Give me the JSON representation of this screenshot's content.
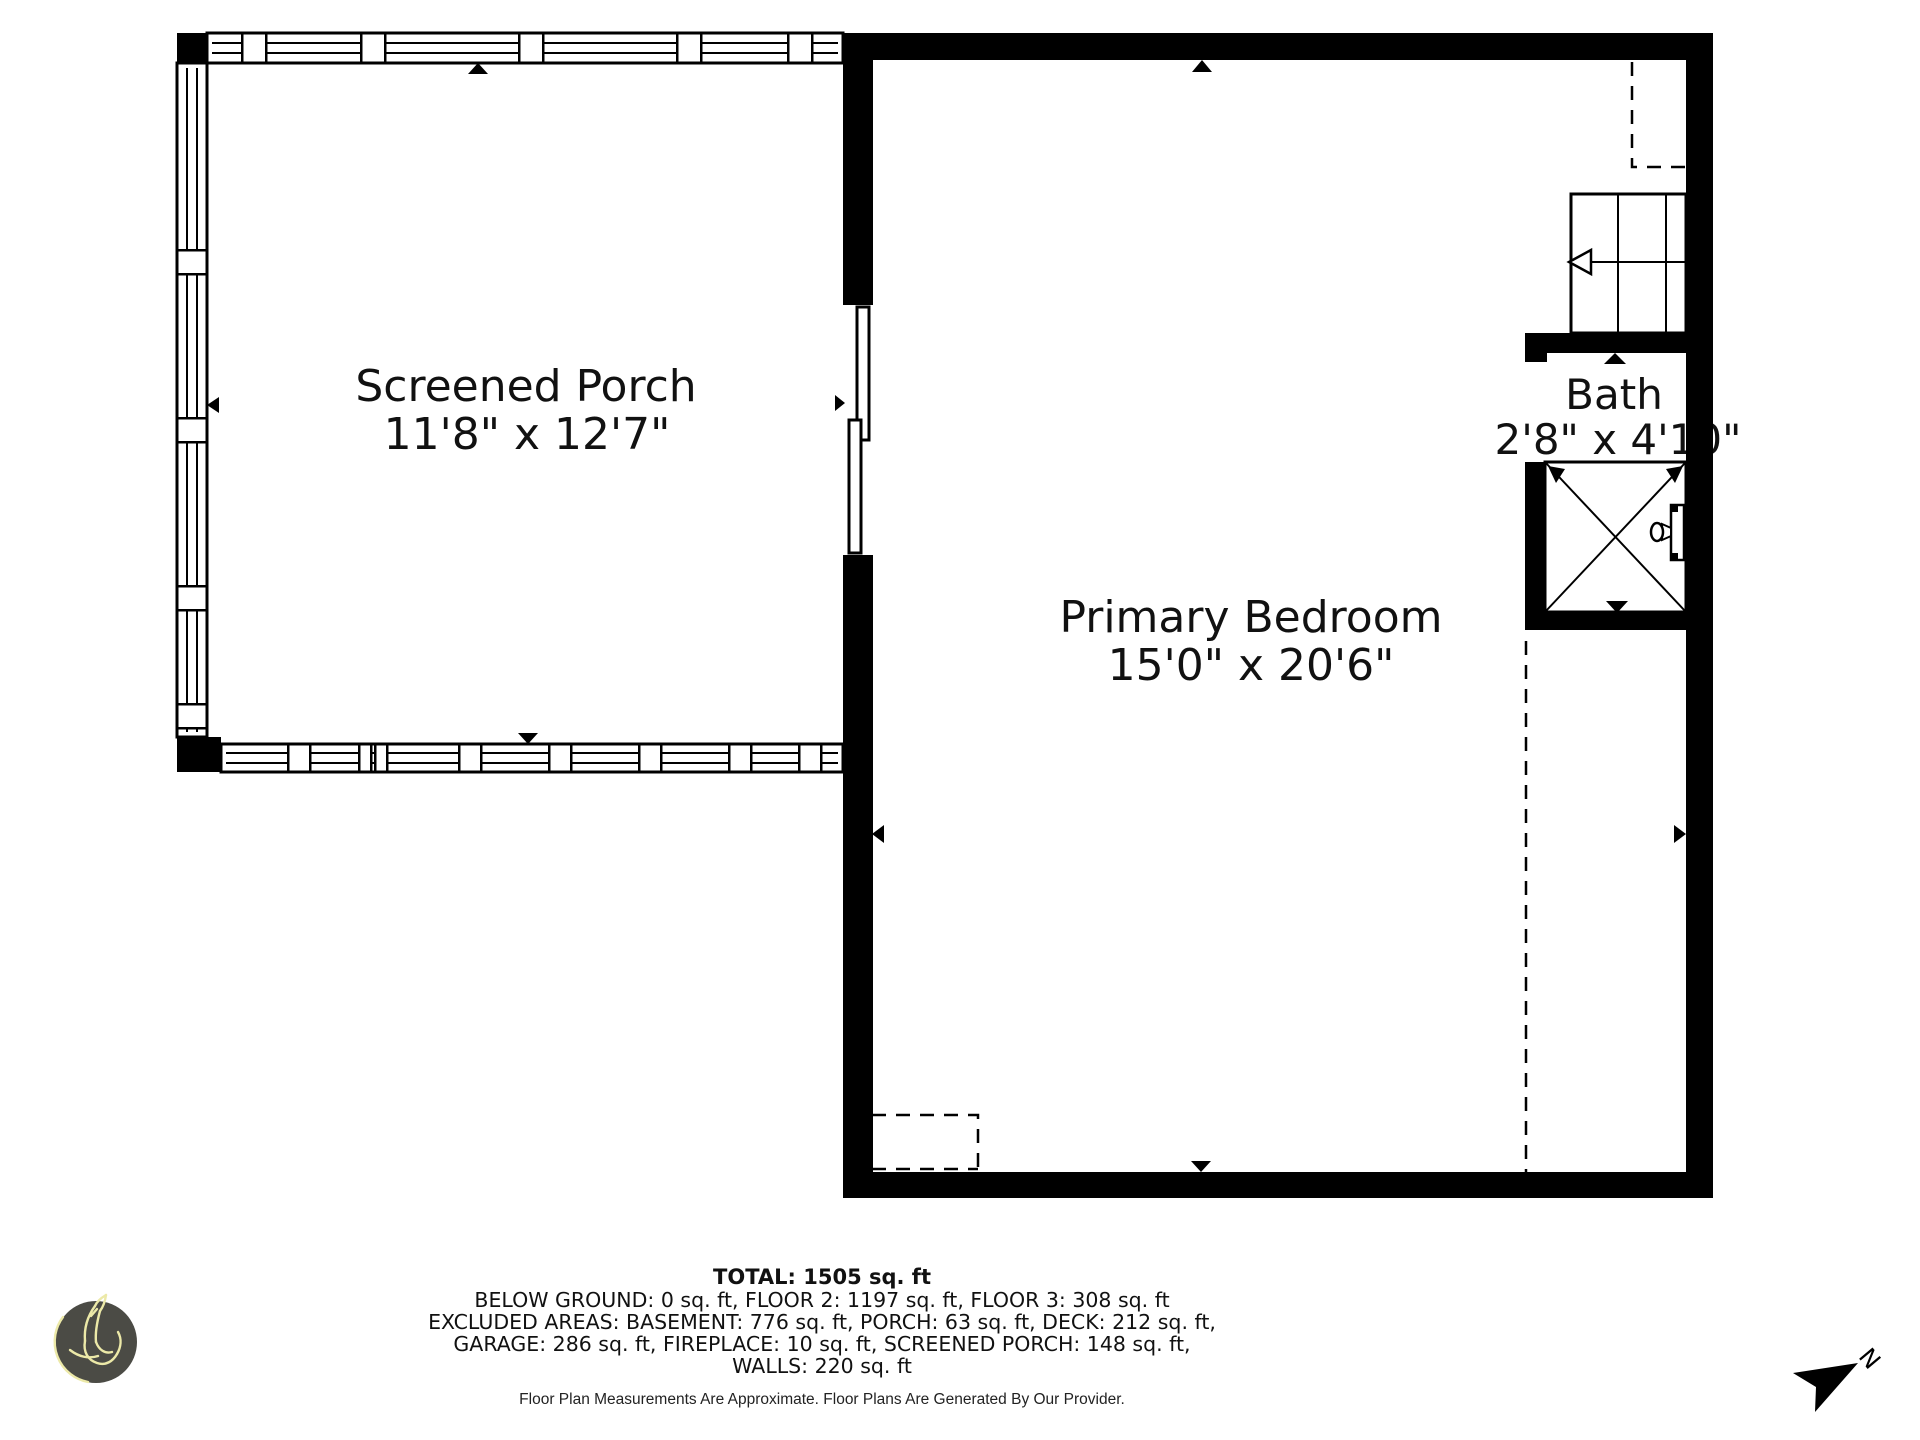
{
  "meta": {
    "background_color": "#ffffff",
    "wall_color": "#000000",
    "text_color": "#111111"
  },
  "rooms": [
    {
      "name": "Screened Porch",
      "dims": "11'8\" x 12'7\""
    },
    {
      "name": "Primary Bedroom",
      "dims": "15'0\" x 20'6\""
    },
    {
      "name": "Bath",
      "dims": "2'8\" x 4'10\""
    }
  ],
  "summary": {
    "total": "TOTAL: 1505 sq. ft",
    "line1": "BELOW GROUND: 0 sq. ft, FLOOR 2: 1197 sq. ft, FLOOR 3: 308 sq. ft",
    "line2": "EXCLUDED AREAS: BASEMENT: 776 sq. ft, PORCH: 63 sq. ft, DECK: 212 sq. ft,",
    "line3": "GARAGE: 286 sq. ft, FIREPLACE: 10 sq. ft, SCREENED PORCH: 148 sq. ft,",
    "line4": "WALLS: 220 sq. ft",
    "disclaimer": "Floor Plan Measurements Are Approximate. Floor Plans Are Generated By Our Provider."
  },
  "compass": {
    "label": "N"
  },
  "logo": {
    "circle_color": "#4b4b45",
    "line_color": "#ece9a8"
  }
}
